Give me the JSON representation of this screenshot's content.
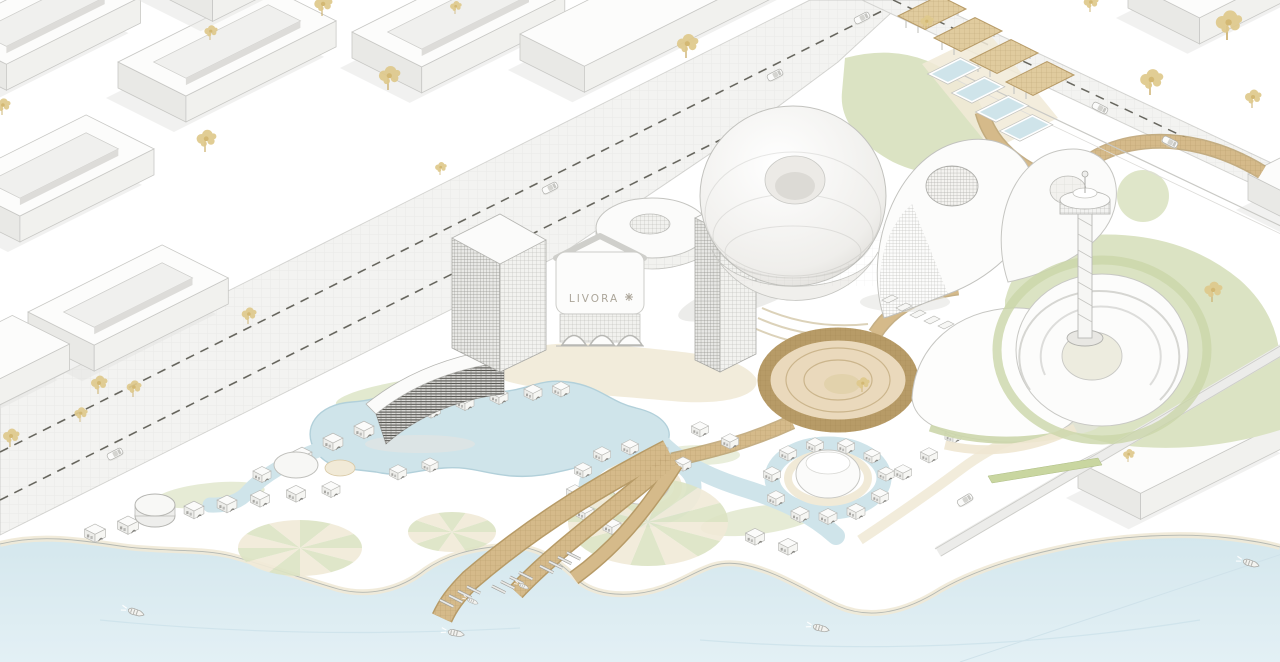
{
  "meta": {
    "title": "LIVORA waterfront resort masterplan - axonometric rendering",
    "view": "isometric aerial"
  },
  "sign": {
    "text": "LIVORA",
    "mark_name": "starburst-logo-mark"
  },
  "palette": {
    "paper": "#ffffff",
    "sea": "#d7e8ee",
    "sea_light": "#e4f1f5",
    "shore_sand": "#f0e9d6",
    "lagoon": "#cfe4ea",
    "lagoon_edge": "#b2d0da",
    "lawn": "#dbe3c3",
    "lawn_dark": "#c2cf9e",
    "cream": "#f1ead7",
    "tan": "#d5ba8a",
    "tan_edge": "#b79b67",
    "road": "#f3f3f1",
    "dash": "#68675f",
    "block_top": "#fcfcfb",
    "block_sw": "#e9e9e6",
    "block_se": "#f1f1ee",
    "outline": "#c6c6c2",
    "building_white": "#fcfcfb",
    "louver_dark": "#504f4a",
    "tree_gold": "#dfc98c",
    "tree_trunk": "#c9ac67",
    "shadow": "#e4e4e1"
  },
  "scene": {
    "buildings": [
      "city-courtyard-blocks",
      "grid-facade-tower",
      "slim-grid-tower",
      "livora-gateway-hall",
      "ellipse-roof-wing",
      "toroidal-dome-pavilion",
      "teardrop-shell-pavilion",
      "second-teardrop-shell",
      "louver-slab-hotel",
      "crescent-building",
      "spiral-ring-building",
      "observation-tower",
      "dome-pavilion-islands",
      "beach-villas",
      "waterfront-slab-buildings"
    ],
    "city_blocks": [
      {
        "o": [
          118,
          88
        ],
        "a": 168,
        "b": 76,
        "r": 1
      },
      {
        "o": [
          -58,
          58
        ],
        "a": 150,
        "b": 72,
        "r": 1
      },
      {
        "o": [
          -48,
          208
        ],
        "a": 150,
        "b": 76,
        "r": 1
      },
      {
        "o": [
          352,
          58
        ],
        "a": 160,
        "b": 78,
        "r": 1
      },
      {
        "o": [
          520,
          60
        ],
        "a": 230,
        "b": 72,
        "r": 0
      },
      {
        "o": [
          28,
          338
        ],
        "a": 150,
        "b": 74,
        "r": 1
      },
      {
        "o": [
          -95,
          395
        ],
        "a": 120,
        "b": 64,
        "r": 0
      },
      {
        "o": [
          150,
          -10
        ],
        "a": 150,
        "b": 70,
        "r": 0
      },
      {
        "o": [
          1128,
          8
        ],
        "a": 150,
        "b": 80,
        "r": 0
      },
      {
        "o": [
          1248,
          200
        ],
        "a": 140,
        "b": 80,
        "r": 0
      },
      {
        "o": [
          1078,
          488
        ],
        "a": 170,
        "b": 70,
        "r": 0
      },
      {
        "o": [
          1262,
          380
        ],
        "a": 120,
        "b": 60,
        "r": 0
      }
    ],
    "trees": [
      [
        205,
        152,
        1.2
      ],
      [
        322,
        16,
        1.1
      ],
      [
        388,
        90,
        1.3
      ],
      [
        98,
        394,
        1.0
      ],
      [
        133,
        397,
        0.9
      ],
      [
        80,
        422,
        0.8
      ],
      [
        10,
        447,
        1.0
      ],
      [
        248,
        324,
        0.9
      ],
      [
        686,
        58,
        1.3
      ],
      [
        1090,
        12,
        0.9
      ],
      [
        926,
        30,
        0.8
      ],
      [
        1227,
        40,
        1.6
      ],
      [
        1150,
        95,
        1.4
      ],
      [
        1252,
        108,
        1.0
      ],
      [
        1212,
        302,
        1.1
      ],
      [
        440,
        175,
        0.7
      ],
      [
        210,
        40,
        0.8
      ],
      [
        2,
        115,
        0.9
      ],
      [
        455,
        14,
        0.7
      ],
      [
        1128,
        462,
        0.7
      ],
      [
        862,
        392,
        0.8
      ]
    ],
    "cars": [
      [
        115,
        454,
        -27
      ],
      [
        550,
        188,
        -27
      ],
      [
        775,
        75,
        -27
      ],
      [
        862,
        18,
        -27
      ],
      [
        1100,
        108,
        27
      ],
      [
        1170,
        142,
        27
      ],
      [
        965,
        500,
        -31
      ]
    ],
    "boats": [
      [
        135,
        612,
        18,
        1
      ],
      [
        455,
        633,
        12,
        1
      ],
      [
        820,
        628,
        15,
        1
      ],
      [
        1250,
        563,
        18,
        1
      ],
      [
        472,
        601,
        25,
        0.7
      ],
      [
        523,
        586,
        25,
        0.65
      ]
    ],
    "villas": [
      [
        95,
        528,
        1.15
      ],
      [
        128,
        520,
        1.15
      ],
      [
        161,
        512,
        1.1
      ],
      [
        194,
        505,
        1.1
      ],
      [
        227,
        499,
        1.1
      ],
      [
        260,
        494,
        1.05
      ],
      [
        296,
        489,
        1.05
      ],
      [
        331,
        485,
        1.0
      ],
      [
        302,
        451,
        1.1
      ],
      [
        333,
        437,
        1.1
      ],
      [
        364,
        425,
        1.1
      ],
      [
        397,
        414,
        1.05
      ],
      [
        431,
        405,
        1.05
      ],
      [
        465,
        398,
        1.0
      ],
      [
        499,
        392,
        1.0
      ],
      [
        533,
        388,
        1.0
      ],
      [
        561,
        385,
        0.95
      ],
      [
        262,
        470,
        1.0
      ],
      [
        398,
        468,
        0.95
      ],
      [
        430,
        461,
        0.9
      ],
      [
        612,
        522,
        1.0
      ],
      [
        585,
        508,
        1.0
      ],
      [
        575,
        488,
        0.95
      ],
      [
        583,
        466,
        0.95
      ],
      [
        602,
        450,
        0.95
      ],
      [
        630,
        443,
        0.95
      ],
      [
        660,
        447,
        0.9
      ],
      [
        683,
        460,
        0.9
      ],
      [
        800,
        510,
        1.0
      ],
      [
        776,
        494,
        0.95
      ],
      [
        772,
        470,
        0.95
      ],
      [
        788,
        449,
        0.95
      ],
      [
        815,
        441,
        0.95
      ],
      [
        846,
        442,
        0.95
      ],
      [
        872,
        452,
        0.9
      ],
      [
        886,
        470,
        0.9
      ],
      [
        880,
        492,
        0.95
      ],
      [
        856,
        507,
        1.0
      ],
      [
        828,
        512,
        1.0
      ],
      [
        700,
        425,
        0.95
      ],
      [
        730,
        437,
        0.95
      ],
      [
        755,
        532,
        1.05
      ],
      [
        788,
        542,
        1.05
      ],
      [
        903,
        468,
        0.95
      ],
      [
        929,
        451,
        0.95
      ],
      [
        953,
        432,
        0.9
      ]
    ],
    "pergolas": [
      [
        898,
        16
      ],
      [
        934,
        38
      ],
      [
        970,
        60
      ],
      [
        1006,
        82
      ]
    ],
    "pools": [
      [
        930,
        74
      ],
      [
        954,
        93
      ],
      [
        978,
        112
      ],
      [
        1002,
        131
      ]
    ],
    "jetties": [
      [
        440,
        600
      ],
      [
        492,
        586
      ],
      [
        540,
        566
      ]
    ],
    "sunbursts": [
      [
        648,
        522,
        80,
        44,
        14
      ],
      [
        300,
        548,
        62,
        28,
        12
      ],
      [
        452,
        532,
        44,
        20,
        10
      ]
    ]
  }
}
